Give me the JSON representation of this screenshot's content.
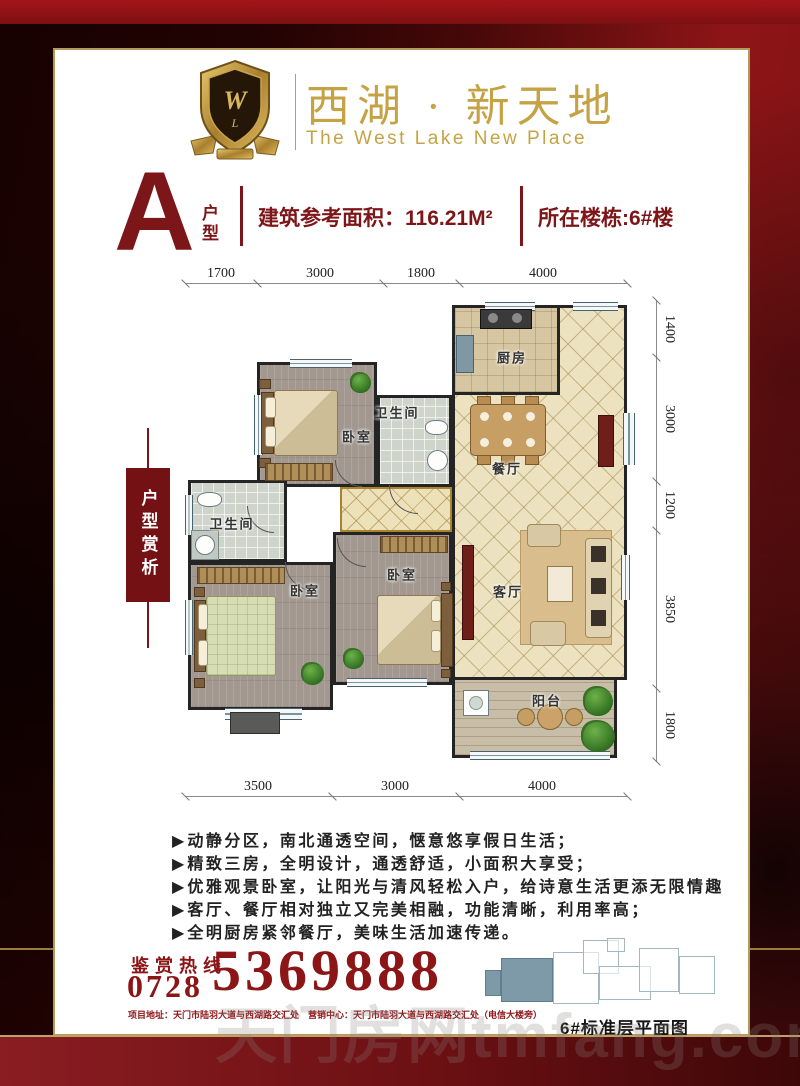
{
  "brand": {
    "title": "西湖 · 新天地",
    "subtitle": "The West Lake New Place",
    "logo_icon": "gold-shield-crest-icon"
  },
  "unit": {
    "type_letter": "A",
    "type_label": "户型",
    "area_label": "建筑参考面积：116.21M²",
    "building_label": "所在楼栋:6#楼"
  },
  "side_tab": {
    "label": "户型赏析"
  },
  "floorplan": {
    "rooms": {
      "kitchen": "厨房",
      "dining": "餐厅",
      "living": "客厅",
      "balcony": "阳台",
      "bedroom1": "卧室",
      "bedroom2": "卧室",
      "bedroom3": "卧室",
      "bath1": "卫生间",
      "bath2": "卫生间"
    },
    "dims_top": [
      "1700",
      "3000",
      "1800",
      "4000"
    ],
    "dims_right": [
      "1400",
      "3000",
      "1200",
      "3850",
      "1800"
    ],
    "dims_bottom": [
      "3500",
      "3000",
      "4000"
    ]
  },
  "features": {
    "bullet": "▶",
    "items": [
      "动静分区，南北通透空间，惬意悠享假日生活；",
      "精致三房，全明设计，通透舒适，小面积大享受；",
      "优雅观景卧室，让阳光与清风轻松入户，给诗意生活更添无限情趣",
      "客厅、餐厅相对独立又完美相融，功能清晰，利用率高；",
      "全明厨房紧邻餐厅，美味生活加速传递。"
    ]
  },
  "contact": {
    "hotline_label": "鉴赏热线",
    "area_code": "0728",
    "phone": "5369888",
    "address_line": "项目地址：天门市陆羽大道与西湖路交汇处　营销中心：天门市陆羽大道与西湖路交汇处（电信大楼旁）"
  },
  "site_plan": {
    "caption": "6#标准层平面图"
  },
  "watermark": {
    "text": "天门房网tmfang.com"
  },
  "colors": {
    "accent_red": "#7c1618",
    "gold": "#c5a345",
    "phone_red": "#8c1517",
    "frame_red": "#8e1517",
    "unit_highlight": "#7e99a8"
  }
}
